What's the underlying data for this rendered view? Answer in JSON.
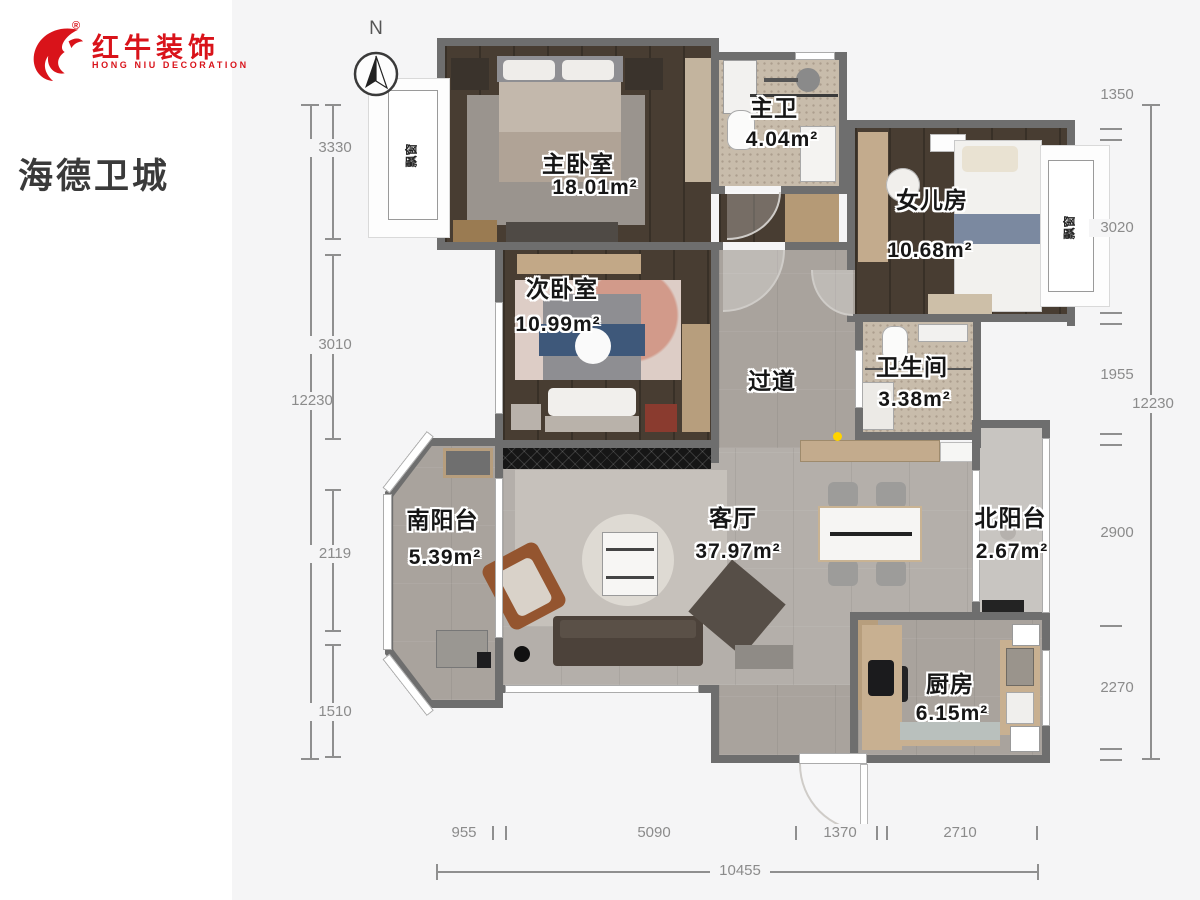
{
  "brand": {
    "name_cn": "红牛装饰",
    "name_en": "HONG NIU DECORATION",
    "registered_mark": "®",
    "logo_color": "#d9131a"
  },
  "project": {
    "title": "海德卫城"
  },
  "compass": {
    "label": "N"
  },
  "rooms": {
    "master_bedroom": {
      "name": "主卧室",
      "area": "18.01m²"
    },
    "master_bath": {
      "name": "主卫",
      "area": "4.04m²"
    },
    "daughter_room": {
      "name": "女儿房",
      "area": "10.68m²"
    },
    "second_bedroom": {
      "name": "次卧室",
      "area": "10.99m²"
    },
    "hallway": {
      "name": "过道",
      "area": ""
    },
    "bathroom": {
      "name": "卫生间",
      "area": "3.38m²"
    },
    "living_room": {
      "name": "客厅",
      "area": "37.97m²"
    },
    "south_balcony": {
      "name": "南阳台",
      "area": "5.39m²"
    },
    "north_balcony": {
      "name": "北阳台",
      "area": "2.67m²"
    },
    "kitchen": {
      "name": "厨房",
      "area": "6.15m²"
    }
  },
  "bay_windows": {
    "left": "飘窗",
    "right": "飘窗"
  },
  "dimensions": {
    "left": {
      "total": "12230",
      "segments": [
        "3330",
        "3010",
        "2119",
        "1510"
      ]
    },
    "right": {
      "total": "12230",
      "segments": [
        "1350",
        "3020",
        "1955",
        "2900",
        "2270"
      ]
    },
    "bottom": {
      "total": "10455",
      "segments": [
        "955",
        "5090",
        "1370",
        "2710"
      ]
    }
  }
}
